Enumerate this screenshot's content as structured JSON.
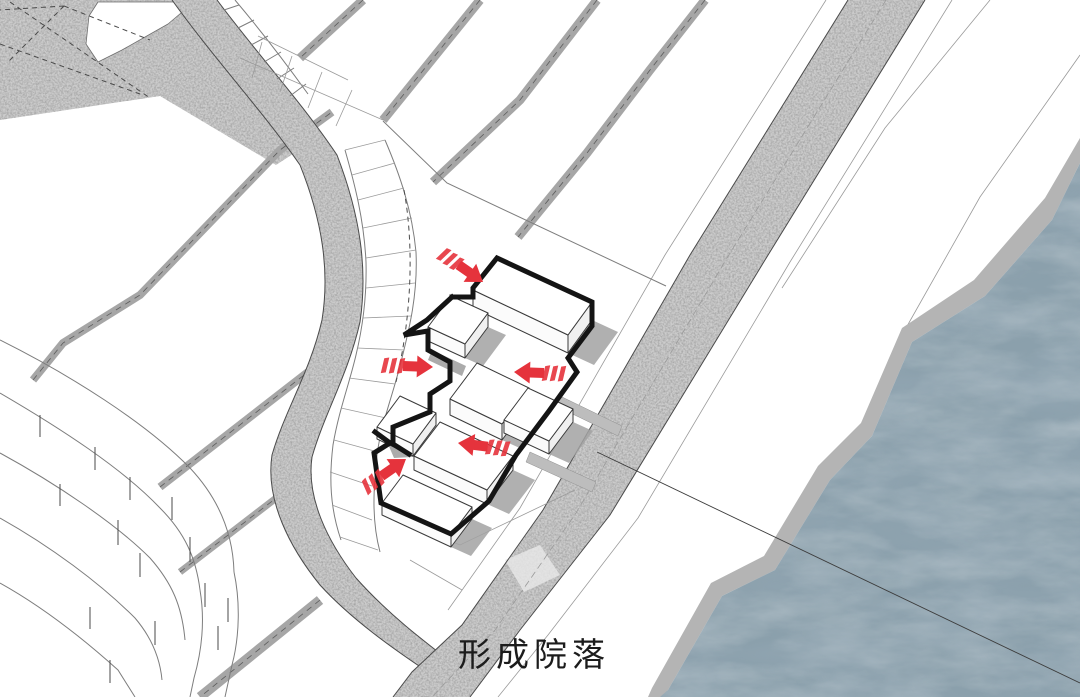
{
  "caption": {
    "text": "形成院落"
  },
  "colors": {
    "paper": "#ffffff",
    "road-gray": "#cccccc",
    "path-gray": "#a6a6a6",
    "edge-dark": "#4a4a4a",
    "line-thin": "#7d7d7d",
    "building-fill": "#ffffff",
    "building-edge": "#3a3a3a",
    "shadow-gray": "#a2a2a2",
    "outline-black": "#141414",
    "arrow-red": "#e5333c",
    "water-base": "#8ba0ac",
    "embankment": "#b4b4b4",
    "text-color": "#1c1c1c"
  },
  "geometry": {
    "stipple_area": "0,0 186,0 215,32 302,148 276,165 160,96 0,120",
    "stipple_parcel": "M98,2 L194,2 L168,24 L122,50 L98,62 L86,44 L89,16 Z",
    "stipple_dashes": "M10,2L150,98 M0,44L140,94 M64,6L8,62 M64,6L150,40 M64,6L0,10",
    "curved_road": {
      "fill": "M172,0 C215,60 262,110 300,165 C322,220 330,270 322,320 C310,372 285,410 272,455 C265,500 290,548 320,585 C352,620 395,650 428,672 L450,697 L470,697 L455,665 C425,642 388,614 356,578 C328,542 306,498 312,457 C325,412 348,375 360,322 C368,268 360,215 337,155 C300,100 258,55 217,0 Z",
      "left": "M172,0 C215,60 262,110 300,165 C322,220 330,270 322,320 C310,372 285,410 272,455 C265,500 290,548 320,585 C352,620 395,650 428,672 L450,697",
      "right": "M217,0 C258,55 300,100 337,155 C360,215 368,268 360,322 C348,375 325,412 312,457 C306,498 328,542 356,578 C388,614 425,642 455,665 L470,697",
      "steps_line": "M235,0 C262,32 285,62 308,94",
      "steps_rungs": "M224,10L239,5 M238,28L254,20 M251,45L268,36 M264,62L281,52 M277,79L294,68 M290,96L306,84"
    },
    "main_road": {
      "fill": "M848,0 L925,0 L765,260 L610,515 L520,630 L470,697 L393,697 L412,672 L462,625 L543,510 L690,255 Z",
      "left": "M848,0 L690,255 L543,510 L462,625 L412,672 L393,697",
      "right": "M925,0 L765,260 L610,515 L520,630 L470,697",
      "center": "M886,0 L727,258 L576,513 L495,630 L432,697",
      "sidewalk": "M952,0 L790,262 L638,518 L548,635 L498,697",
      "inner_margin": "M826,0 L665,255 L520,508 L448,610"
    },
    "strips": [
      {
        "d": "M363,0 L300,58",
        "w": 9
      },
      {
        "d": "M480,0 L383,120",
        "w": 9
      },
      {
        "d": "M597,0 L520,100 L433,182",
        "w": 9
      },
      {
        "d": "M705,0 L650,70 L587,153 L518,237",
        "w": 9
      },
      {
        "d": "M33,380 L63,343 L140,295 L280,150 L332,112",
        "w": 8
      },
      {
        "d": "M160,487 L308,372",
        "w": 8
      },
      {
        "d": "M180,572 L310,472",
        "w": 7
      },
      {
        "d": "M320,600 L200,697",
        "w": 10
      }
    ],
    "fan": {
      "arc_a": "M345,150 C355,185 364,220 366,262 C367,300 362,330 356,355 C349,385 339,410 333,445 C329,478 330,508 341,540",
      "arc_b": "M385,140 C400,175 412,210 416,252 C418,295 409,330 401,362 C392,398 381,424 377,455 C373,492 372,522 380,552",
      "rungs": "M345,150L385,140 M352,175L395,163 M358,200L404,188 M363,228L412,218 M366,258L416,250 M366,288L415,283 M363,318L411,316 M357,348L404,350 M349,378L395,384 M341,408L386,418 M334,440L378,452 M330,472L372,486 M332,505L372,520 M340,537L378,550",
      "dashed": "M404,190 C414,245 412,315 396,382",
      "upper_grid": "M240,58 L383,120 M258,36 L348,80 M262,42 L252,78 M292,56 L280,92 M322,72 L308,108 M352,90 L336,126"
    },
    "terraces": {
      "curves": "M0,340 C70,375 145,422 190,468 C220,500 233,535 234,572 M0,393 C60,428 122,468 160,508 C185,533 196,558 200,590 M0,453 C55,483 115,523 150,558 C172,583 182,606 185,640 M0,518 C50,546 100,583 135,618 C152,638 160,658 162,680 M0,583 C45,608 88,643 118,670 L135,697 M234,572 C240,600 240,635 232,665 L225,697 M200,590 C205,620 202,650 194,678 L190,697",
      "ticks": "M40,415L40,437 M95,447L95,470 M60,484L60,506 M118,520L118,545 M140,553L140,577 M90,607L90,629 M155,621L155,645 M190,537L190,562 M205,583L205,607 M218,626L218,650 M130,477L130,500 M172,497L172,520 M228,598L228,622 M110,660L110,683"
    },
    "upper_boundary": "M383,121 L447,183 L666,286",
    "bank_lines": [
      {
        "d": "M990,0 L885,128 L782,288"
      },
      {
        "d": "M1080,55 L980,197 L906,328"
      }
    ],
    "section_line": "M597,452 L1080,683",
    "embankment": "M1080,138 L1045,198 L974,280 L902,328 L861,423 L818,466 L764,556 L711,583 L652,688 L648,697 L662,697 L668,690 L722,596 L775,570 L830,480 L872,436 L912,342 L985,296 L1052,220 L1080,163 Z",
    "water": "M1080,163 L1052,220 L985,296 L912,342 L872,436 L830,480 L775,570 L722,596 L668,690 L660,697 L1080,697 Z",
    "site_lines": "M386,515 L460,545 L575,490 M410,560 L462,590",
    "plateau_strips": [
      {
        "points": "560,396 622,426 618,436 556,406"
      },
      {
        "points": "530,452 596,482 592,492 526,462"
      }
    ],
    "road_patch": "505,560 540,545 560,575 524,592"
  },
  "site": {
    "bold_outline": [
      {
        "points": "452,297 473,297 473,288 497,258 592,302 592,326 568,358 577,372 549,411 516,455 489,501 451,534 381,503 374,453 390,443 375,432"
      },
      {
        "points": "452,297 427,320 404,335 428,331 428,350 450,362 450,381 430,394 430,412 393,427 393,444 409,454"
      }
    ],
    "buildings": {
      "b1": {
        "top": "497,258 592,302 568,335 473,290",
        "left": "473,290 568,335 568,353 473,308",
        "right": "592,302 568,335 568,353 592,320",
        "shadow": "568,353 592,320 618,332 594,365"
      },
      "b2": {
        "top": "451,296 488,313 465,344 428,327",
        "left": "428,327 465,344 465,358 428,341",
        "right": "488,313 465,344 465,358 488,327",
        "shadow": "465,358 488,327 506,335 483,366"
      },
      "b3": {
        "top": "477,363 529,388 502,424 450,399",
        "left": "450,399 502,424 502,440 450,415",
        "right": "529,388 502,424 502,440 529,404",
        "shadow": "502,440 529,404 549,413 522,449"
      },
      "b4": {
        "top": "528,388 573,409 549,441 504,420",
        "left": "504,420 549,441 549,454 504,433",
        "right": "573,409 549,441 549,454 573,422",
        "shadow": "549,454 573,422 593,431 569,463"
      },
      "b7": {
        "top": "400,396 436,413 413,444 377,427",
        "left": "377,427 413,444 413,456 377,439",
        "right": "436,413 413,444 413,456 436,425",
        "shadow": "413,456 436,425 452,433 429,464"
      },
      "b5": {
        "top": "440,422 513,456 487,490 414,456",
        "left": "414,456 487,490 487,504 414,470",
        "right": "513,456 487,490 487,504 513,470",
        "shadow": "487,504 513,470 535,480 509,514"
      },
      "b6": {
        "top": "403,475 472,507 451,535 382,503",
        "left": "382,503 451,535 451,547 382,515",
        "right": "472,507 451,535 451,547 472,519",
        "shadow": "451,547 472,519 492,528 471,556"
      }
    },
    "courtyard_patches": [
      {
        "points": "432,350 466,366 462,376 428,360"
      },
      {
        "points": "388,444 424,442 430,456 394,458"
      }
    ]
  },
  "arrows": [
    {
      "transform": "translate(483,282) rotate(35)"
    },
    {
      "transform": "translate(514,372) rotate(182)"
    },
    {
      "transform": "translate(433,367) rotate(2)"
    },
    {
      "transform": "translate(458,443) rotate(187)"
    },
    {
      "transform": "translate(406,459) rotate(-35)"
    }
  ]
}
